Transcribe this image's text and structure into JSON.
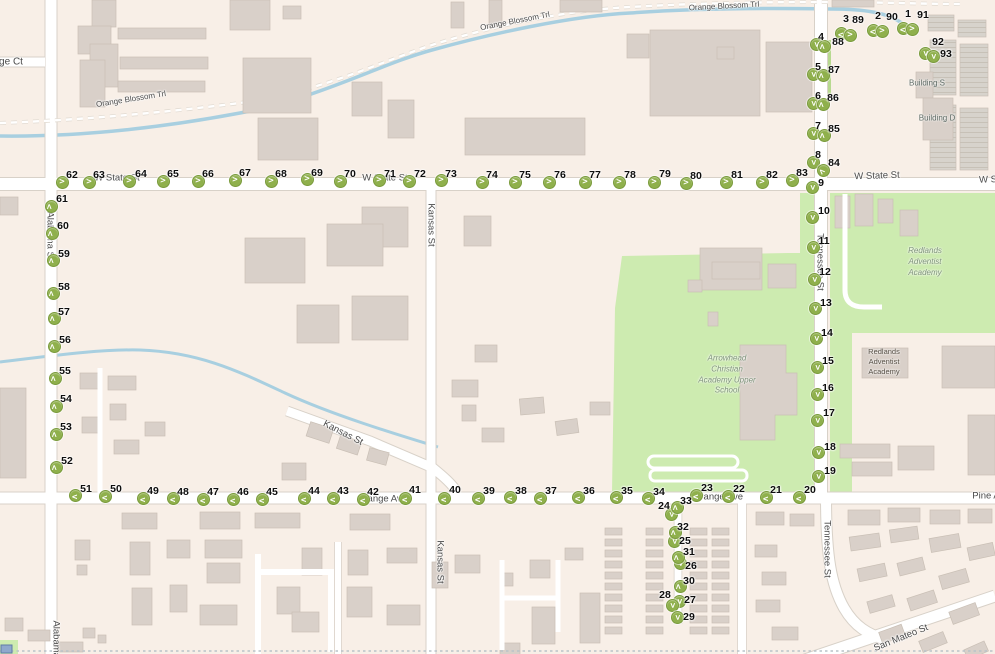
{
  "map": {
    "colors": {
      "background": "#f8efe7",
      "road": "#ffffff",
      "road_casing": "#d8d1c8",
      "green_area": "#cdebb0",
      "water": "#a8cfe0",
      "building": "#d9d0c9",
      "marker_fill": "#8fb04c",
      "marker_border": "#7a9b3c",
      "label_text": "#4a4a4a"
    },
    "street_labels": [
      {
        "text": "ge Ct",
        "x": 11,
        "y": 62,
        "rot": 0,
        "size": 10
      },
      {
        "text": "Orange Blossom Trl",
        "x": 131,
        "y": 99,
        "rot": -9,
        "size": 8
      },
      {
        "text": "Orange Blossom Trl",
        "x": 515,
        "y": 21,
        "rot": -11,
        "size": 8
      },
      {
        "text": "Orange Blossom Trl",
        "x": 724,
        "y": 6,
        "rot": -3,
        "size": 8
      },
      {
        "text": "W State St",
        "x": 117,
        "y": 178,
        "rot": 0,
        "size": 9.5
      },
      {
        "text": "W State St",
        "x": 385,
        "y": 178,
        "rot": 0,
        "size": 9.5
      },
      {
        "text": "W State St",
        "x": 877,
        "y": 176,
        "rot": -2,
        "size": 9.5
      },
      {
        "text": "W S",
        "x": 988,
        "y": 180,
        "rot": -2,
        "size": 9.5
      },
      {
        "text": "Alabama St",
        "x": 50,
        "y": 236,
        "rot": 90,
        "size": 9.5
      },
      {
        "text": "Alabama St",
        "x": 56,
        "y": 645,
        "rot": 90,
        "size": 9.5
      },
      {
        "text": "Kansas St",
        "x": 431,
        "y": 225,
        "rot": 90,
        "size": 9.5
      },
      {
        "text": "Kansas St",
        "x": 343,
        "y": 433,
        "rot": 27,
        "size": 9.5
      },
      {
        "text": "Kansas St",
        "x": 440,
        "y": 562,
        "rot": 90,
        "size": 9.5
      },
      {
        "text": "Tennessee St",
        "x": 820,
        "y": 262,
        "rot": 90,
        "size": 9.5
      },
      {
        "text": "Tennessee St",
        "x": 827,
        "y": 549,
        "rot": 90,
        "size": 9.5
      },
      {
        "text": "Orange Ave",
        "x": 382,
        "y": 499,
        "rot": 0,
        "size": 9.5
      },
      {
        "text": "Orange Ave",
        "x": 718,
        "y": 497,
        "rot": 0,
        "size": 9.5
      },
      {
        "text": "Pine A",
        "x": 986,
        "y": 496,
        "rot": 0,
        "size": 9.5
      },
      {
        "text": "San Mateo St",
        "x": 901,
        "y": 638,
        "rot": -22,
        "size": 9.5
      }
    ],
    "area_labels": [
      {
        "lines": [
          "Redlands",
          "Adventist",
          "Academy"
        ],
        "x": 925,
        "y": 262,
        "italic": true,
        "color": "#7f937b",
        "size": 8
      },
      {
        "lines": [
          "Arrowhead",
          "Christian",
          "Academy Upper",
          "School"
        ],
        "x": 727,
        "y": 375,
        "italic": true,
        "color": "#7f937b",
        "size": 8
      },
      {
        "lines": [
          "Redlands",
          "Adventist",
          "Academy"
        ],
        "x": 884,
        "y": 362,
        "italic": false,
        "color": "#554e44",
        "size": 7.5
      },
      {
        "lines": [
          "Building S"
        ],
        "x": 927,
        "y": 84,
        "italic": false,
        "color": "#5d6a64",
        "size": 8
      },
      {
        "lines": [
          "Building D"
        ],
        "x": 937,
        "y": 119,
        "italic": false,
        "color": "#5d6a64",
        "size": 8
      }
    ],
    "markers": [
      [
        1,
        903,
        28,
        "l",
        908,
        14
      ],
      [
        2,
        873,
        30,
        "l",
        878,
        16
      ],
      [
        3,
        841,
        33,
        "l",
        846,
        19
      ],
      [
        4,
        816,
        44,
        "d",
        821,
        37
      ],
      [
        5,
        813,
        74,
        "d",
        818,
        67
      ],
      [
        6,
        813,
        103,
        "d",
        818,
        96
      ],
      [
        7,
        813,
        133,
        "d",
        818,
        126
      ],
      [
        8,
        813,
        162,
        "d",
        818,
        155
      ],
      [
        9,
        812,
        187,
        "d",
        821,
        183
      ],
      [
        10,
        812,
        217,
        "d",
        824,
        211
      ],
      [
        11,
        813,
        247,
        "d",
        824,
        241
      ],
      [
        12,
        814,
        279,
        "d",
        825,
        272
      ],
      [
        13,
        815,
        308,
        "d",
        826,
        303
      ],
      [
        14,
        816,
        338,
        "d",
        827,
        333
      ],
      [
        15,
        817,
        367,
        "d",
        828,
        361
      ],
      [
        16,
        817,
        394,
        "d",
        828,
        388
      ],
      [
        17,
        817,
        420,
        "d",
        829,
        413
      ],
      [
        18,
        818,
        452,
        "d",
        830,
        447
      ],
      [
        19,
        818,
        476,
        "d",
        830,
        471
      ],
      [
        20,
        799,
        497,
        "l",
        810,
        490
      ],
      [
        21,
        766,
        497,
        "l",
        776,
        490
      ],
      [
        22,
        728,
        496,
        "l",
        739,
        489
      ],
      [
        23,
        696,
        495,
        "l",
        707,
        488
      ],
      [
        24,
        671,
        514,
        "d",
        664,
        506
      ],
      [
        25,
        674,
        541,
        "d",
        685,
        541
      ],
      [
        26,
        680,
        563,
        "d",
        691,
        566
      ],
      [
        27,
        679,
        601,
        "d",
        690,
        600
      ],
      [
        28,
        672,
        605,
        "d",
        665,
        595
      ],
      [
        29,
        677,
        617,
        "d",
        689,
        617
      ],
      [
        30,
        680,
        586,
        "u",
        689,
        581
      ],
      [
        31,
        678,
        557,
        "u",
        689,
        552
      ],
      [
        32,
        675,
        532,
        "u",
        683,
        527
      ],
      [
        33,
        677,
        507,
        "u",
        686,
        501
      ],
      [
        34,
        648,
        498,
        "l",
        659,
        492
      ],
      [
        35,
        616,
        497,
        "l",
        627,
        491
      ],
      [
        36,
        578,
        497,
        "l",
        589,
        491
      ],
      [
        37,
        540,
        498,
        "l",
        551,
        491
      ],
      [
        38,
        510,
        497,
        "l",
        521,
        491
      ],
      [
        39,
        478,
        498,
        "l",
        489,
        491
      ],
      [
        40,
        444,
        498,
        "l",
        455,
        490
      ],
      [
        41,
        405,
        498,
        "l",
        415,
        490
      ],
      [
        42,
        363,
        499,
        "l",
        373,
        492
      ],
      [
        43,
        333,
        498,
        "l",
        343,
        491
      ],
      [
        44,
        304,
        498,
        "l",
        314,
        491
      ],
      [
        45,
        262,
        499,
        "l",
        272,
        492
      ],
      [
        46,
        233,
        499,
        "l",
        243,
        492
      ],
      [
        47,
        203,
        499,
        "l",
        213,
        492
      ],
      [
        48,
        173,
        498,
        "l",
        183,
        492
      ],
      [
        49,
        143,
        498,
        "l",
        153,
        491
      ],
      [
        50,
        105,
        496,
        "l",
        116,
        489
      ],
      [
        51,
        75,
        495,
        "l",
        86,
        489
      ],
      [
        52,
        56,
        467,
        "u",
        67,
        461
      ],
      [
        53,
        56,
        434,
        "u",
        66,
        427
      ],
      [
        54,
        56,
        406,
        "u",
        66,
        399
      ],
      [
        55,
        55,
        378,
        "u",
        65,
        371
      ],
      [
        56,
        54,
        346,
        "u",
        65,
        340
      ],
      [
        57,
        54,
        318,
        "u",
        64,
        312
      ],
      [
        58,
        53,
        293,
        "u",
        64,
        287
      ],
      [
        59,
        53,
        260,
        "u",
        64,
        254
      ],
      [
        60,
        52,
        233,
        "u",
        63,
        226
      ],
      [
        61,
        51,
        206,
        "u",
        62,
        199
      ],
      [
        62,
        62,
        182,
        "r",
        72,
        175
      ],
      [
        63,
        89,
        182,
        "r",
        99,
        175
      ],
      [
        64,
        129,
        181,
        "r",
        141,
        174
      ],
      [
        65,
        163,
        181,
        "r",
        173,
        174
      ],
      [
        66,
        198,
        181,
        "r",
        208,
        174
      ],
      [
        67,
        235,
        180,
        "r",
        245,
        173
      ],
      [
        68,
        271,
        181,
        "r",
        281,
        174
      ],
      [
        69,
        307,
        179,
        "r",
        317,
        173
      ],
      [
        70,
        340,
        181,
        "r",
        350,
        174
      ],
      [
        71,
        379,
        180,
        "r",
        390,
        174
      ],
      [
        72,
        409,
        181,
        "r",
        420,
        174
      ],
      [
        73,
        441,
        180,
        "r",
        451,
        174
      ],
      [
        74,
        482,
        182,
        "r",
        492,
        175
      ],
      [
        75,
        515,
        182,
        "r",
        525,
        175
      ],
      [
        76,
        549,
        182,
        "r",
        560,
        175
      ],
      [
        77,
        585,
        182,
        "r",
        595,
        175
      ],
      [
        78,
        619,
        182,
        "r",
        630,
        175
      ],
      [
        79,
        654,
        182,
        "r",
        665,
        174
      ],
      [
        80,
        686,
        183,
        "r",
        696,
        176
      ],
      [
        81,
        726,
        182,
        "r",
        737,
        175
      ],
      [
        82,
        762,
        182,
        "r",
        772,
        175
      ],
      [
        83,
        792,
        180,
        "r",
        802,
        173
      ],
      [
        84,
        823,
        170,
        "ul",
        834,
        163
      ],
      [
        85,
        824,
        135,
        "u",
        834,
        129
      ],
      [
        86,
        823,
        104,
        "u",
        833,
        98
      ],
      [
        87,
        823,
        75,
        "u",
        834,
        70
      ],
      [
        88,
        824,
        46,
        "u",
        838,
        42
      ],
      [
        89,
        850,
        35,
        "r",
        858,
        20
      ],
      [
        90,
        882,
        31,
        "r",
        892,
        17
      ],
      [
        91,
        912,
        29,
        "r",
        923,
        15
      ],
      [
        92,
        925,
        53,
        "d",
        938,
        42
      ],
      [
        93,
        933,
        56,
        "d",
        946,
        54
      ]
    ]
  }
}
